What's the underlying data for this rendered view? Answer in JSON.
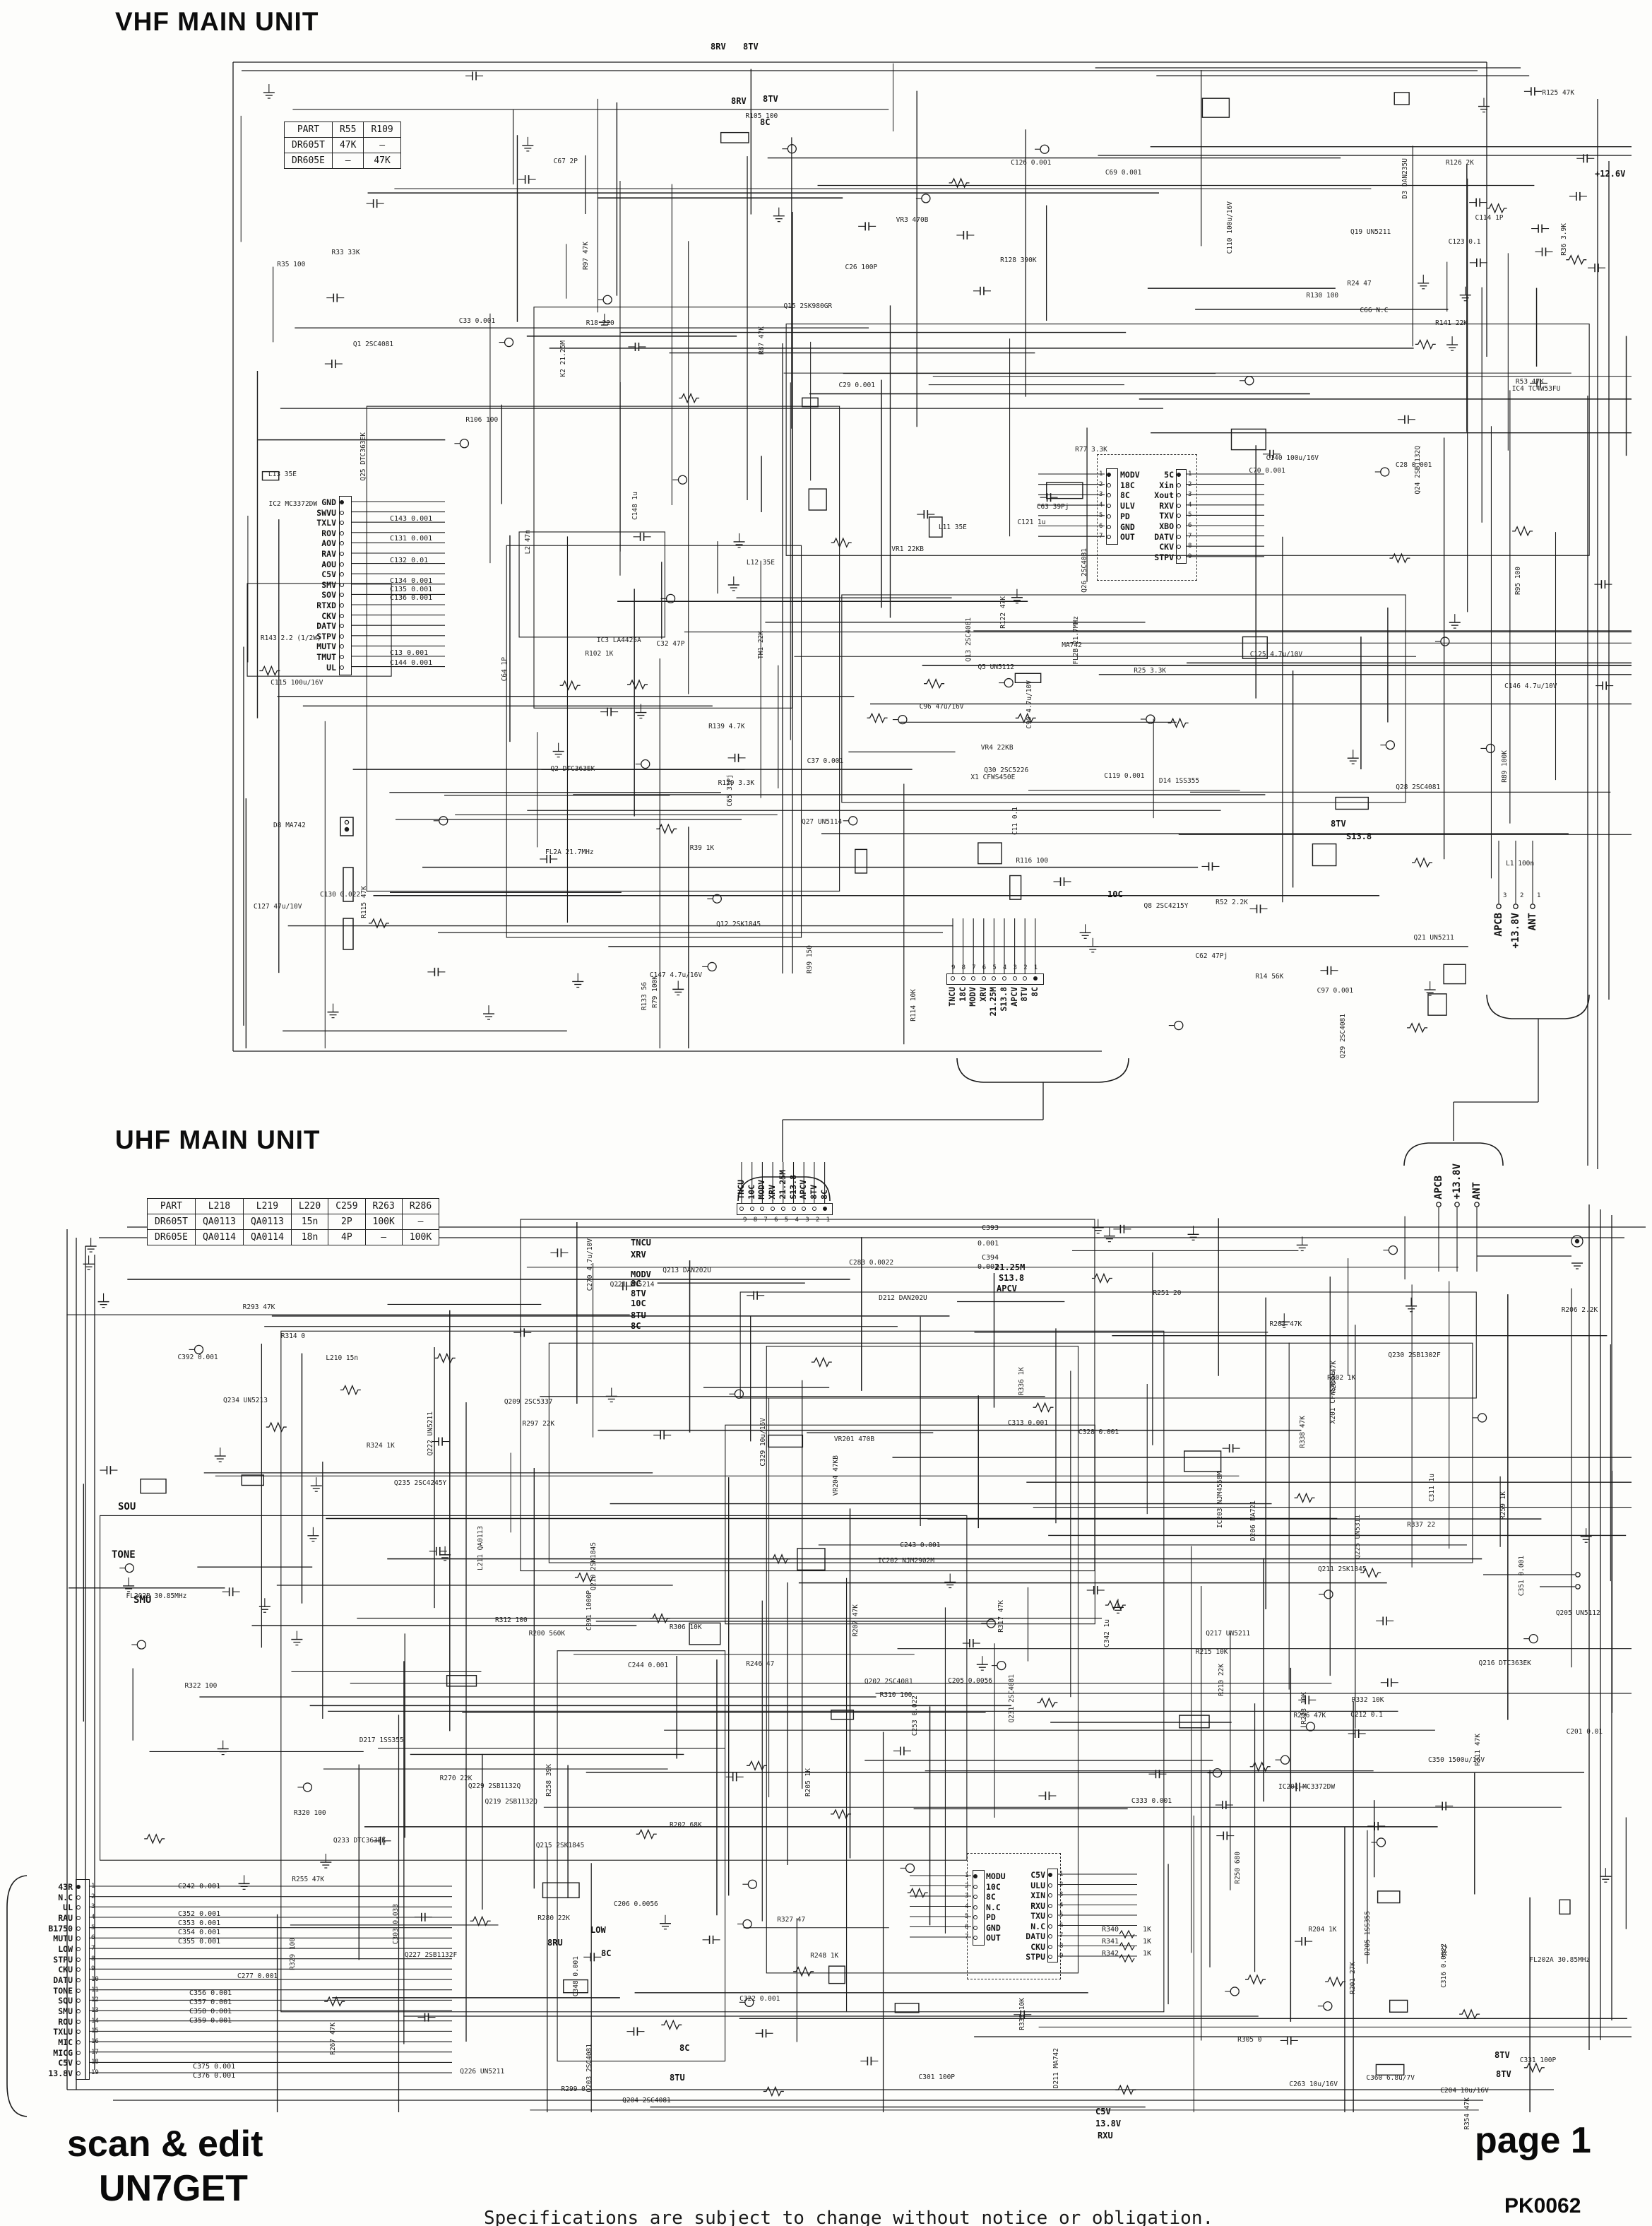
{
  "vhf": {
    "title": "VHF MAIN UNIT",
    "parts_table": {
      "headers": [
        "PART",
        "R55",
        "R109"
      ],
      "rows": [
        [
          "DR605T",
          "47K",
          "–"
        ],
        [
          "DR605E",
          "–",
          "47K"
        ]
      ]
    },
    "rails": [
      "8RV",
      "8TV",
      "8C",
      "8RV",
      "8TV",
      "+12.6V",
      "8TV",
      "S13.8",
      "10C"
    ],
    "cn1": {
      "name": "CN1",
      "type": "17PS-JE",
      "first_pin": "1",
      "last_pin": "17",
      "caption": "TO CPU UNIT",
      "pins": [
        "GND",
        "SWVU",
        "TXLV",
        "ROV",
        "AOV",
        "RAV",
        "AOU",
        "C5V",
        "SMV",
        "SOV",
        "RTXD",
        "CKV",
        "DATV",
        "STPV",
        "MUTV",
        "TMUT",
        "UL"
      ],
      "caps": [
        "C143 0.001",
        "C131 0.001",
        "C132 0.01",
        "C134 0.001",
        "C135 0.001",
        "C136 0.001",
        "C13 0.001",
        "C144 0.001"
      ]
    },
    "sp": {
      "label": "SP",
      "conn": "CN2",
      "part": "P122A02M"
    },
    "ext": {
      "label": "EXT.SP/UART",
      "conn": "JK1",
      "part": "HSJ1493-01-010"
    },
    "pkt": {
      "label": "9600PKT",
      "conn": "JK2",
      "part": "HSJ1102-01-540"
    },
    "vco": {
      "title": "VHF VCO UNIT",
      "coil": "L19 10u",
      "left": {
        "name": "CN501",
        "type": "B7P-BC-2",
        "pins": [
          "MODV",
          "18C",
          "8C",
          "ULV",
          "PD",
          "GND",
          "OUT"
        ]
      },
      "right": {
        "name": "CN502",
        "type": "B9P-BC-2",
        "pins": [
          "5C",
          "Xin",
          "Xout",
          "RXV",
          "TXV",
          "XBO",
          "DATV",
          "CKV",
          "STPV"
        ],
        "note": "N.C N.C N.C"
      }
    },
    "cn3": {
      "name": "CN3",
      "code": "0062030912",
      "caption": "TO UHF MAIN UNIT",
      "pins": [
        "TNCU",
        "18C",
        "MODV",
        "XRV",
        "21.25M",
        "S13.8",
        "APCV",
        "8TV",
        "8C"
      ]
    },
    "out_right": {
      "pins": [
        "APCB",
        "+13.8V",
        "ANT"
      ],
      "caption": "TO UHF MAIN UNIT",
      "note_a": "C124",
      "note_b": "N.C"
    },
    "components": [
      "X1 CFWS450E",
      "IC2 MC3372DW",
      "IC3 LA4425A",
      "IC4 TC4W53FU",
      "FL2A 21.7MHz",
      "FL2B 21.7MHz",
      "Q1 2SC4081",
      "Q2 DTC363EK",
      "Q5 UN5112",
      "Q8 2SC4215Y",
      "Q12 2SK1845",
      "Q13 2SC4081",
      "Q15 2SK980GR",
      "Q19 UN5211",
      "Q21 UN5211",
      "Q24 2SB1132Q",
      "Q25 DTC363EK",
      "Q26 2SC4081",
      "Q27 UN5114",
      "Q28 2SC4081",
      "Q29 2SC4081",
      "Q30 2SC5226",
      "D3 DAN235U",
      "D8 MA742",
      "D14 1SS355",
      "L1 100n",
      "L2 47n",
      "L11 35E",
      "L12 35E",
      "L13 35E",
      "R14 56K",
      "R18 220",
      "R24 47",
      "R25 3.3K",
      "R33 33K",
      "R35 100",
      "R36 3.9K",
      "R39 1K",
      "R52 2.2K",
      "R53 47K",
      "R77 3.3K",
      "R87 47K",
      "R89 100K",
      "R99 150",
      "R102 1K",
      "R105 100",
      "R114 10K",
      "R115 47K",
      "R125 47K",
      "R126 2K",
      "R128 390K",
      "R129 3.3K",
      "R133 56",
      "R139 4.7K",
      "R141 22K",
      "R143 2.2 (1/2W)",
      "VR1 22KB",
      "VR3 470B",
      "VR4 22KB",
      "C11 0.1",
      "C26 100P",
      "C28 0.001",
      "C29 0.001",
      "C32 47P",
      "C33 0.001",
      "C37 0.001",
      "C62 47Pj",
      "C63 39Pj",
      "C64 1P",
      "C65 33Pj",
      "C66 N.C",
      "C67 2P",
      "C69 0.001",
      "C70 0.001",
      "C90 4.7u/10V",
      "C96 47u/16V",
      "C97 0.001",
      "C110 100u/16V",
      "C114 1P",
      "C115 100u/16V",
      "C119 0.001",
      "C121 1u",
      "C123 0.1",
      "C125 4.7u/10V",
      "C126 0.001",
      "C127 47u/10V",
      "C130 0.022",
      "C140 100u/16V",
      "C146 4.7u/10V",
      "C147 4.7u/16V",
      "C148 1u",
      "K2 21.25M",
      "TH1 22K",
      "MA742",
      "R116 100",
      "R122 47K",
      "R79 100K",
      "R95 100",
      "R97 47K",
      "R106 100",
      "R130 100"
    ]
  },
  "uhf": {
    "title": "UHF MAIN UNIT",
    "parts_table": {
      "headers": [
        "PART",
        "L218",
        "L219",
        "L220",
        "C259",
        "R263",
        "R286"
      ],
      "rows": [
        [
          "DR605T",
          "QA0113",
          "QA0113",
          "15n",
          "2P",
          "100K",
          "–"
        ],
        [
          "DR605E",
          "QA0114",
          "QA0114",
          "18n",
          "4P",
          "–",
          "100K"
        ]
      ]
    },
    "in_top": {
      "caption": "TO VHF MAIN UNIT",
      "name": "CN202",
      "code": "25_5004_00",
      "pins": [
        "TNCU",
        "10C",
        "MODV",
        "XRV",
        "21.25M",
        "S13.8",
        "APCV",
        "8TV",
        "8C"
      ],
      "caps": [
        "C393 0.001",
        "C394 0.001"
      ]
    },
    "left_rails": [
      "TNCU",
      "XRV",
      "MODV",
      "8C",
      "8TV",
      "10C",
      "8TU",
      "8C"
    ],
    "mid_rails": [
      "21.25M",
      "S13.8",
      "APCV"
    ],
    "audio_rails": [
      "SOU",
      "TONE",
      "SMU"
    ],
    "bottom_rails": [
      "LOW",
      "8RU",
      "8C",
      "8TU",
      "8C",
      "8TV",
      "8TV",
      "C5V",
      "13.8V",
      "RXU"
    ],
    "vco": {
      "title": "UHF VCO UNIT",
      "left": {
        "name": "CN601",
        "type": "B7P-BC-2",
        "pins": [
          "MODU",
          "10C",
          "8C",
          "N.C",
          "PD",
          "GND",
          "OUT"
        ]
      },
      "right": {
        "name": "CN602",
        "type": "B9P-BC-2",
        "pins": [
          "C5V",
          "ULU",
          "XIN",
          "RXU",
          "TXU",
          "N.C",
          "DATU",
          "CKU",
          "STPU"
        ]
      },
      "resistors": [
        "R340 1K",
        "R341 1K",
        "R342 1K"
      ]
    },
    "cn201": {
      "name": "CN201",
      "type": "19PS-JE",
      "caption": "TO CPU UNIT",
      "pins": [
        "43R",
        "N.C",
        "UL",
        "RAU",
        "B1750",
        "MUTU",
        "LOW",
        "STPU",
        "CKU",
        "DATU",
        "TONE",
        "SQU",
        "SMU",
        "ROU",
        "TXLU",
        "MIC",
        "MICG",
        "C5V",
        "13.8V"
      ],
      "caps_a": [
        "C242 0.001",
        "C352 0.001",
        "C353 0.001",
        "C354 0.001",
        "C355 0.001"
      ],
      "caps_b": [
        "C356 0.001",
        "C357 0.001",
        "C358 0.001",
        "C359 0.001"
      ],
      "caps_c": [
        "C375 0.001",
        "C376 0.001"
      ]
    },
    "out_right": {
      "pins": [
        "APCB",
        "+13.8V",
        "ANT"
      ],
      "jack": "A30-30190-15",
      "jack_ref": "JK201"
    },
    "power": {
      "ref_a": "JK202A",
      "v": "13.8V",
      "gnd": "GND",
      "ref_b": "JK202B"
    },
    "components": [
      "X201 CFWS455E",
      "IC201 MC3372DW",
      "IC202 NJM2902M",
      "IC203 NJM4558M",
      "FL202A 30.85MHz",
      "FL202B 30.85MHz",
      "Q202 2SC4081",
      "Q203 2SC4081",
      "Q204 2SC4081",
      "Q205 UN5112",
      "Q209 2SC5337",
      "Q210 2SK1845",
      "Q211 2SK1845",
      "Q213 DAN202U",
      "Q215 2SK1845",
      "Q216 DTC363EK",
      "Q217 UN5211",
      "Q219 2SB1132Q",
      "Q221 UN5214",
      "Q222 UN5211",
      "Q225 UN5311",
      "Q226 UN5211",
      "Q227 2SB1132F",
      "Q229 2SB1132Q",
      "Q230 2SB1302F",
      "Q231 2SC4081",
      "Q233 DTC363EK",
      "Q234 UN5213",
      "Q235 2SC4245Y",
      "D205 1SS355",
      "D206 MA721",
      "D211 MA742",
      "D212 DAN202U",
      "D217 1SS355",
      "L210 15n",
      "L211 QA0113",
      "R200 560K",
      "R201 27K",
      "R202 68K",
      "R203 47K",
      "R204 1K",
      "R205 1K",
      "R206 2.2K",
      "R207 47K",
      "R210 22K",
      "R215 10K",
      "R223 10K",
      "R246 47",
      "R248 1K",
      "R250 680",
      "R251 20",
      "R255 47K",
      "R258 39K",
      "R259 1K",
      "R267 47K",
      "R270 22K",
      "R280 22K",
      "R287 47K",
      "R293 47K",
      "R296 47K",
      "R297 22K",
      "R299 0",
      "R302 1K",
      "R305 0",
      "R306 10K",
      "R310 100",
      "R311 47K",
      "R312 100",
      "R314 0",
      "R317 47K",
      "R320 100",
      "R322 100",
      "R324 1K",
      "R327 47",
      "R329 100",
      "R332 10K",
      "R333 10K",
      "R336 1K",
      "R337 22",
      "R338 47K",
      "R354 47K",
      "VR201 470B",
      "VR204 47KB",
      "C201 0.01",
      "C204 10u/16V",
      "C205 0.0056",
      "C206 0.0056",
      "C212 0.1",
      "C243 0.001",
      "C244 0.001",
      "C253 0.022",
      "C263 10u/16V",
      "C270 4.7u/10V",
      "C277 0.001",
      "C283 0.0022",
      "C301 100P",
      "C303 0.033",
      "C311 1u",
      "C313 0.001",
      "C316 0.0022",
      "C322 0.001",
      "C328 0.001",
      "C329 10u/16V",
      "C331 100P",
      "C333 0.001",
      "C342 1u",
      "C348 0.001",
      "C350 1500u/16V",
      "C351 0.001",
      "C360 6.8u/7V",
      "C391 1000P",
      "C392 0.001",
      "TP2"
    ]
  },
  "footer": {
    "credit1": "scan & edit",
    "credit2": "UN7GET",
    "page_label": "page 1",
    "doc_code": "PK0062",
    "disclaimer": "Specifications are subject to change without notice or obligation."
  }
}
